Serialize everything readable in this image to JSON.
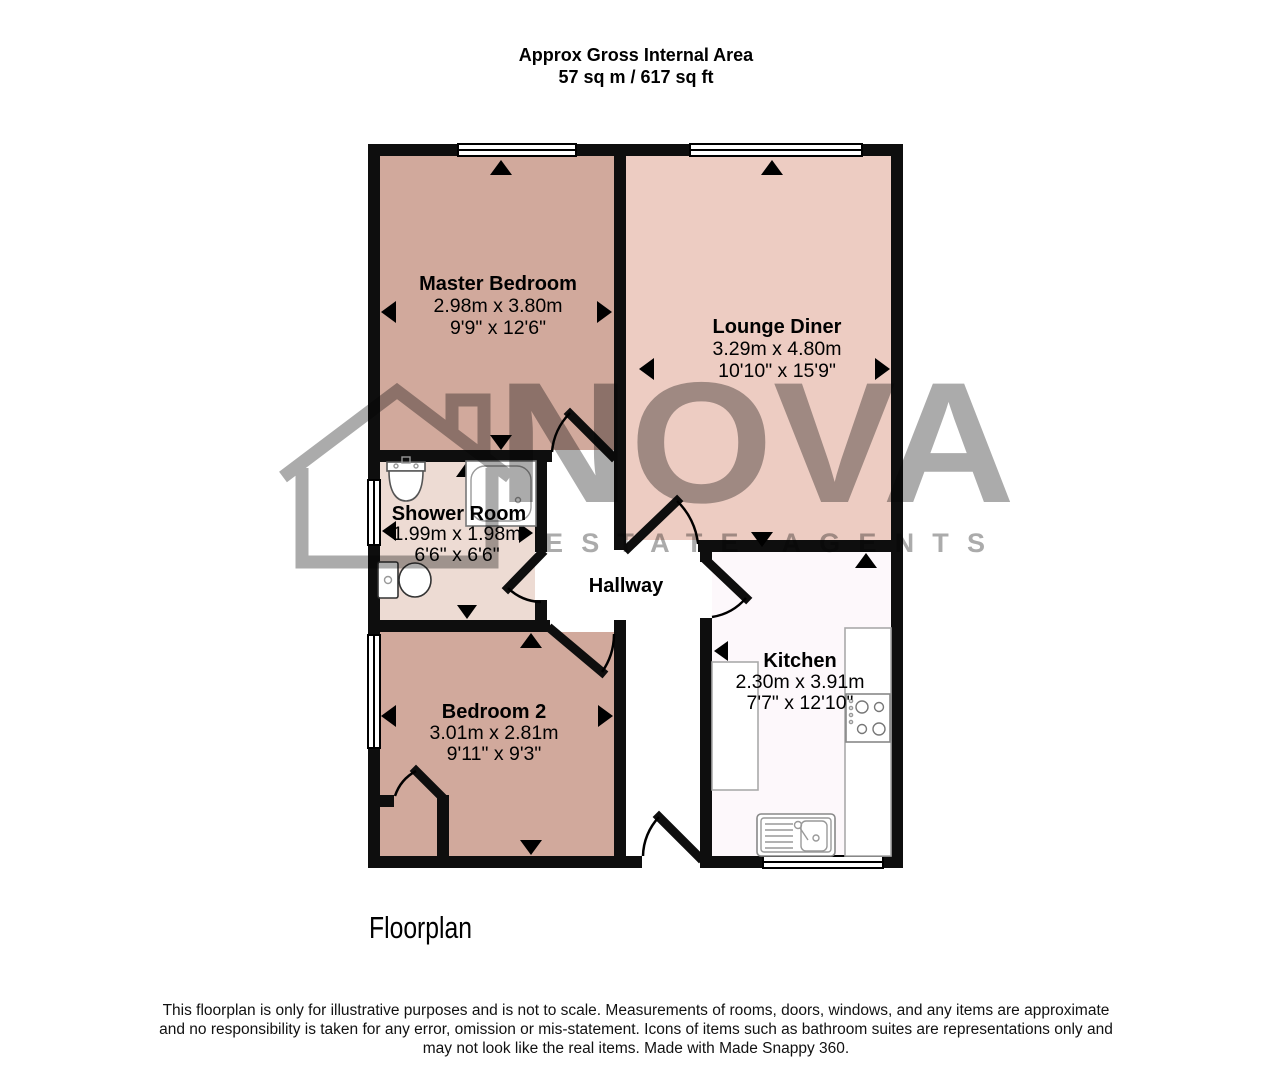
{
  "header": {
    "line1": "Approx Gross Internal Area",
    "line2": "57 sq m / 617 sq ft"
  },
  "rooms": {
    "master_bedroom": {
      "name": "Master Bedroom",
      "metric": "2.98m x 3.80m",
      "imperial": "9'9\" x 12'6\""
    },
    "lounge_diner": {
      "name": "Lounge Diner",
      "metric": "3.29m x 4.80m",
      "imperial": "10'10\" x 15'9\""
    },
    "shower_room": {
      "name": "Shower Room",
      "metric": "1.99m x 1.98m",
      "imperial": "6'6\" x 6'6\""
    },
    "hallway": {
      "name": "Hallway"
    },
    "bedroom_2": {
      "name": "Bedroom 2",
      "metric": "3.01m x 2.81m",
      "imperial": "9'11\" x 9'3\""
    },
    "kitchen": {
      "name": "Kitchen",
      "metric": "2.30m x 3.91m",
      "imperial": "7'7\" x 12'10\""
    }
  },
  "watermark": {
    "brand": "NOVA",
    "tagline": "ESTATE AGENTS"
  },
  "caption": "Floorplan",
  "disclaimer": {
    "line1": "This floorplan is only for illustrative purposes and is not to scale. Measurements of rooms, doors, windows, and any items are approximate",
    "line2": "and no responsibility is taken for any error, omission or mis-statement. Icons of items such as bathroom suites are representations only and",
    "line3": "may not look like the real items. Made with Made Snappy 360."
  },
  "colors": {
    "wall": "#0e0e0e",
    "bedroom_fill": "#d1a99c",
    "lounge_fill": "#edccc2",
    "shower_fill": "#eddbd3",
    "kitchen_fill": "#fdf8fb",
    "hallway_fill": "#ffffff",
    "watermark_gray": "#ababab"
  }
}
